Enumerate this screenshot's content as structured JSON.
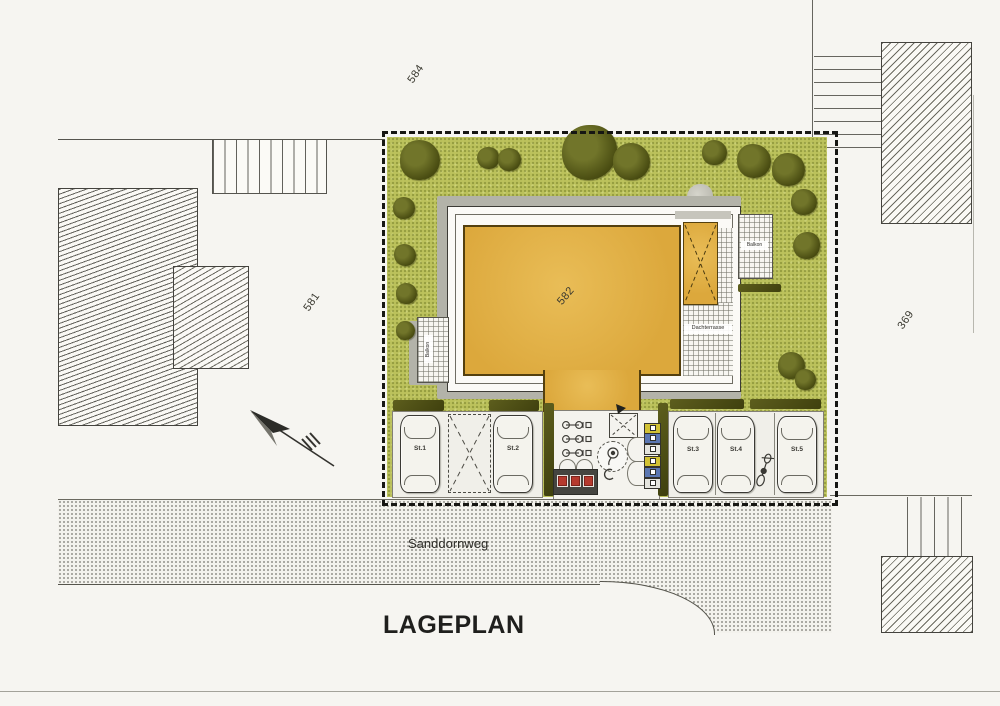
{
  "title": "LAGEPLAN",
  "street": {
    "name": "Sanddornweg"
  },
  "parcels": {
    "plot": "582",
    "neighbor_left": "581",
    "neighbor_top": "584",
    "neighbor_right": "369"
  },
  "building": {
    "roof_terrace": "Dachterrasse",
    "balcony_right": "Balkon",
    "balcony_left": "Balkon"
  },
  "parking": {
    "stalls": [
      {
        "label": "St.1"
      },
      {
        "label": "St.2"
      },
      {
        "label": "St.3"
      },
      {
        "label": "St.4"
      },
      {
        "label": "St.5"
      }
    ]
  },
  "colors": {
    "garden_green": "#bcc25c",
    "roof_orange": "#dca83c",
    "tree_olive": "#4a4d12",
    "shadow_grey": "#b3b3a9",
    "hedge_dark": "#4f5016",
    "waste_bin_red": "#b63a2e",
    "recycling_yellow": "#d2c235",
    "recycling_blue": "#5b77b2",
    "recycling_grey": "#e4e4de"
  },
  "icons": {
    "north_arrow": "svg dart arrow pointing north-west",
    "tree": "olive-green circle",
    "car": "top-view car outline",
    "bicycle": "two-wheel top view",
    "motorcycle": "scooter top view",
    "waste_containers": "three red squares",
    "recycling_boxes": "yellow/blue/grey stacked boxes"
  }
}
